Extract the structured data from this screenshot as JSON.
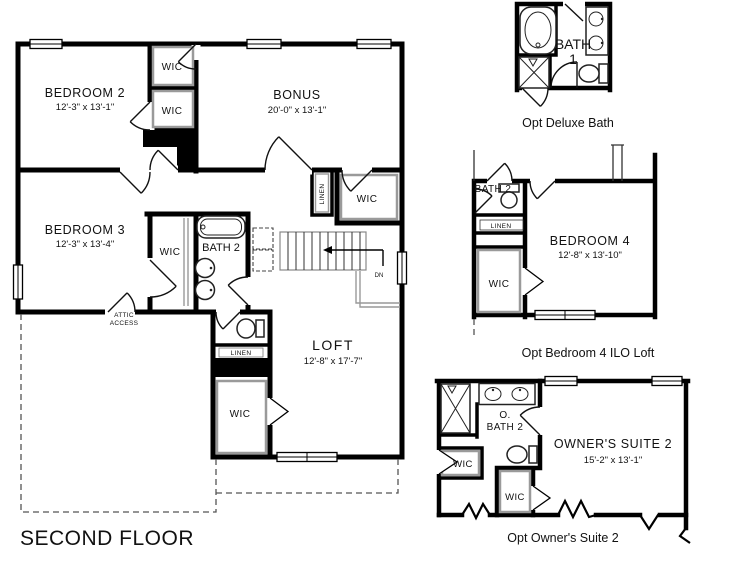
{
  "title": {
    "label": "SECOND FLOOR"
  },
  "colors": {
    "wall": "#000000",
    "shelf": "#9a9a9a",
    "text": "#111111",
    "background": "#ffffff"
  },
  "main_plan": {
    "bedroom2": {
      "name": "BEDROOM 2",
      "dims": "12'-3\" x 13'-1\""
    },
    "bonus": {
      "name": "BONUS",
      "dims": "20'-0\" x 13'-1\""
    },
    "bedroom3": {
      "name": "BEDROOM 3",
      "dims": "12'-3\" x 13'-4\""
    },
    "bath2": {
      "name": "BATH 2"
    },
    "loft": {
      "name": "LOFT",
      "dims": "12'-8\" x 17'-7\""
    },
    "wic": "WIC",
    "linen": "LINEN",
    "attic_access": {
      "line1": "ATTIC",
      "line2": "ACCESS"
    },
    "stairs": {
      "down": "DN"
    }
  },
  "opt_deluxe_bath": {
    "bath_line1": "BATH",
    "bath_line2": "1",
    "caption": "Opt Deluxe Bath"
  },
  "opt_bedroom4": {
    "name": "BEDROOM 4",
    "dims": "12'-8\" x 13'-10\"",
    "bath": "BATH 2",
    "linen": "LINEN",
    "wic": "WIC",
    "caption": "Opt Bedroom 4 ILO Loft"
  },
  "opt_owners_suite2": {
    "name": "OWNER'S SUITE 2",
    "dims": "15'-2\" x 13'-1\"",
    "bath_line1": "O.",
    "bath_line2": "BATH 2",
    "wic": "WIC",
    "caption": "Opt Owner's Suite 2"
  }
}
